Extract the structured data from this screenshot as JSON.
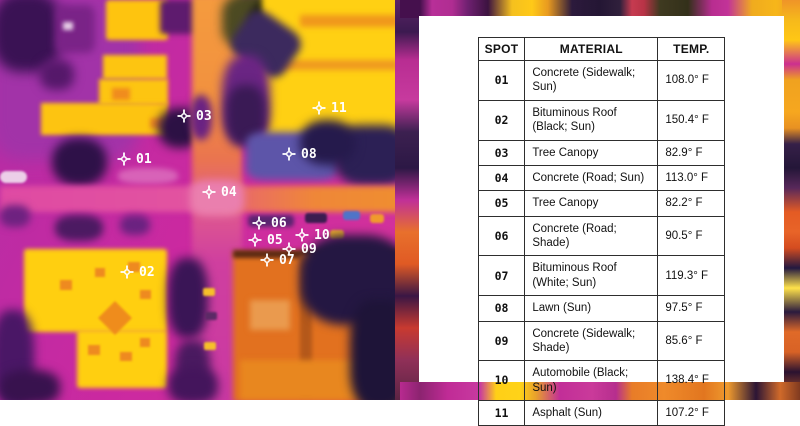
{
  "thermal_panel": {
    "description": "Thermal aerial image of a city block",
    "spots": [
      {
        "id": "01",
        "x": 124,
        "y": 159
      },
      {
        "id": "02",
        "x": 127,
        "y": 272
      },
      {
        "id": "03",
        "x": 184,
        "y": 116
      },
      {
        "id": "04",
        "x": 209,
        "y": 192
      },
      {
        "id": "05",
        "x": 255,
        "y": 240
      },
      {
        "id": "06",
        "x": 259,
        "y": 223
      },
      {
        "id": "07",
        "x": 267,
        "y": 260
      },
      {
        "id": "08",
        "x": 289,
        "y": 154
      },
      {
        "id": "09",
        "x": 289,
        "y": 249
      },
      {
        "id": "10",
        "x": 302,
        "y": 235
      },
      {
        "id": "11",
        "x": 319,
        "y": 108
      }
    ]
  },
  "table": {
    "headers": [
      "SPOT",
      "MATERIAL",
      "TEMP."
    ],
    "rows": [
      {
        "spot": "01",
        "material": "Concrete (Sidewalk; Sun)",
        "temp": "108.0° F"
      },
      {
        "spot": "02",
        "material": "Bituminous Roof (Black; Sun)",
        "temp": "150.4° F"
      },
      {
        "spot": "03",
        "material": "Tree Canopy",
        "temp": "82.9° F"
      },
      {
        "spot": "04",
        "material": "Concrete (Road; Sun)",
        "temp": "113.0° F"
      },
      {
        "spot": "05",
        "material": "Tree Canopy",
        "temp": "82.2° F"
      },
      {
        "spot": "06",
        "material": "Concrete (Road; Shade)",
        "temp": "90.5° F"
      },
      {
        "spot": "07",
        "material": "Bituminous Roof (White; Sun)",
        "temp": "119.3° F"
      },
      {
        "spot": "08",
        "material": "Lawn (Sun)",
        "temp": "97.5° F"
      },
      {
        "spot": "09",
        "material": "Concrete (Sidewalk; Shade)",
        "temp": "85.6° F"
      },
      {
        "spot": "10",
        "material": "Automobile (Black; Sun)",
        "temp": "138.4° F"
      },
      {
        "spot": "11",
        "material": "Asphalt (Sun)",
        "temp": "107.2° F"
      }
    ]
  },
  "colors": {
    "hot_yellow": "#ffd013",
    "warm_orange": "#ef8a2a",
    "base_magenta": "#cb29a0",
    "cool_purple": "#a233a8",
    "cold_navy": "#241638",
    "lawn_blue": "#5d55a9",
    "marker_white": "#ffffff",
    "card_bg": "#ffffff",
    "table_border": "#2e2e2e"
  }
}
